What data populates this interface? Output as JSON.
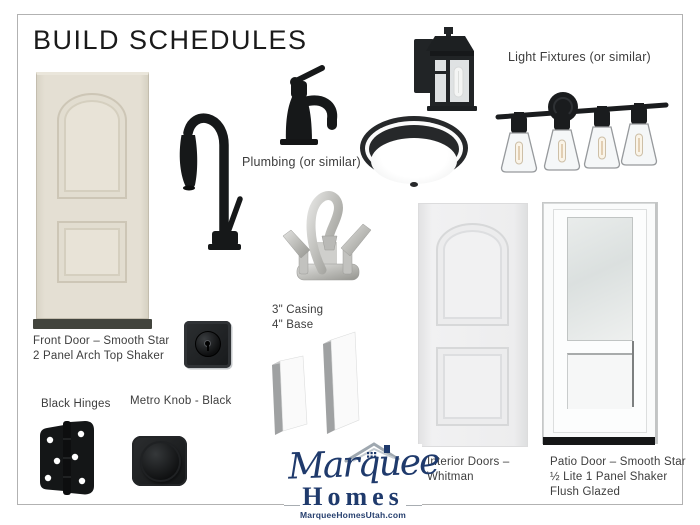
{
  "page": {
    "title": "BUILD SCHEDULES"
  },
  "sections": {
    "plumbing_label": "Plumbing (or similar)",
    "light_fixtures_label": "Light Fixtures (or similar)"
  },
  "items": {
    "front_door": {
      "line1": "Front Door – Smooth Star",
      "line2": "2 Panel Arch Top Shaker"
    },
    "trim": {
      "line1": "3\" Casing",
      "line2": "4\" Base"
    },
    "hinges": {
      "label": "Black Hinges"
    },
    "knob": {
      "label": "Metro Knob - Black"
    },
    "interior_doors": {
      "line1": "Interior Doors –",
      "line2": "Whitman"
    },
    "patio_door": {
      "line1": "Patio Door – Smooth Star",
      "line2": "½ Lite 1 Panel Shaker",
      "line3": "Flush Glazed"
    }
  },
  "logo": {
    "brand_script": "Marquee",
    "brand_name": "Homes",
    "website": "MarqueeHomesUtah.com"
  },
  "product_images": [
    "front-door-smooth-star",
    "black-pulldown-kitchen-faucet",
    "black-single-handle-bath-faucet",
    "brushed-nickel-centerset-faucet",
    "black-outdoor-wall-lantern",
    "black-flush-mount-ceiling-light",
    "black-4-light-vanity-fixture",
    "black-square-deadbolt",
    "casing-trim-board",
    "base-trim-board",
    "black-door-hinge",
    "metro-knob-black",
    "interior-door-whitman",
    "patio-door-half-lite"
  ],
  "colors": {
    "accent_navy": "#1f3a6c",
    "door_cream": "#e3ded2",
    "fixture_black": "#17191a",
    "nickel": "#c4c4c0",
    "page_border": "#b2b2b2"
  }
}
